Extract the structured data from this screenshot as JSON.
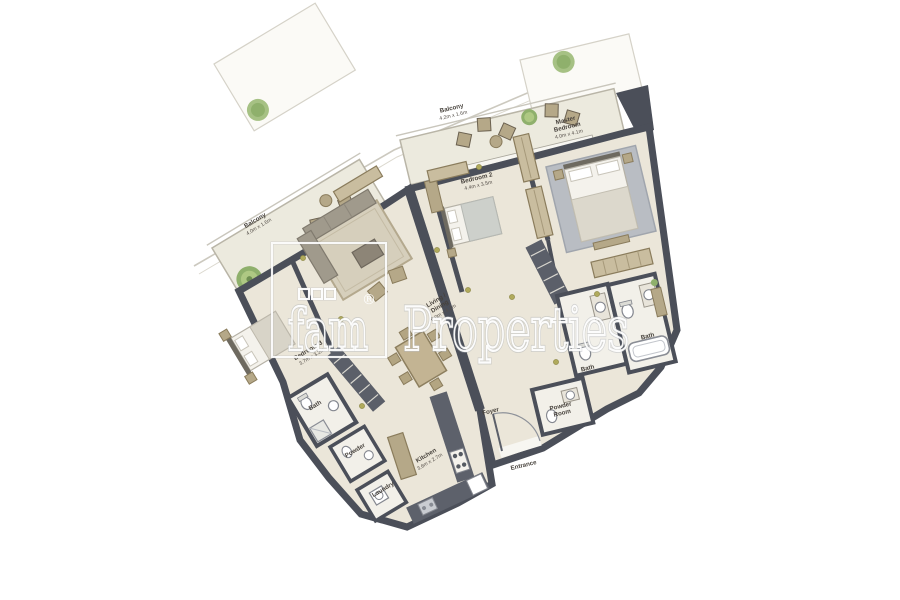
{
  "page": {
    "background": "#ffffff",
    "type": "apartment floor plan"
  },
  "watermark": {
    "brand": "fam",
    "registered": "®",
    "suffix": "Properties"
  },
  "rooms": {
    "balcony_left": {
      "name": "Balcony",
      "dims": "4.0m x 1.6m"
    },
    "balcony_top": {
      "name": "Balcony",
      "dims": "4.2m x 1.6m"
    },
    "master_bedroom": {
      "line1": "Master",
      "line2": "Bedroom",
      "dims": "4.0m x 4.1m"
    },
    "bedroom2": {
      "name": "Bedroom 2",
      "dims": "4.4m x 3.5m"
    },
    "bedroom3": {
      "name": "Bedroom 3",
      "dims": "3.7m x 3.2m"
    },
    "living_dining": {
      "line1": "Living /",
      "line2": "Dining",
      "dims": "6.0m x 4.2m"
    },
    "kitchen": {
      "name": "Kitchen",
      "dims": "3.6m x 2.7m"
    },
    "foyer": {
      "name": "Foyer"
    },
    "powder_room": {
      "line1": "Powder",
      "line2": "Room"
    },
    "entrance": {
      "name": "Entrance"
    },
    "bath_left": {
      "name": "Bath"
    },
    "powder_left": {
      "name": "Powder"
    },
    "laundry": {
      "name": "Laundry"
    },
    "bath_mid": {
      "name": "Bath"
    },
    "bath_master": {
      "name": "Bath"
    }
  },
  "colors": {
    "wall": "#4b4f59",
    "floor": "#ebe6d9",
    "balcony_floor": "#eceade",
    "furniture_tan": "#b5a888",
    "furniture_dark": "#5b5f69",
    "plant_green": "#8fb06c",
    "bed_white": "#f4f2ec",
    "rug_gray": "#b9bdc3",
    "label_text": "#47423c",
    "watermark_stroke": "#ffffff"
  }
}
